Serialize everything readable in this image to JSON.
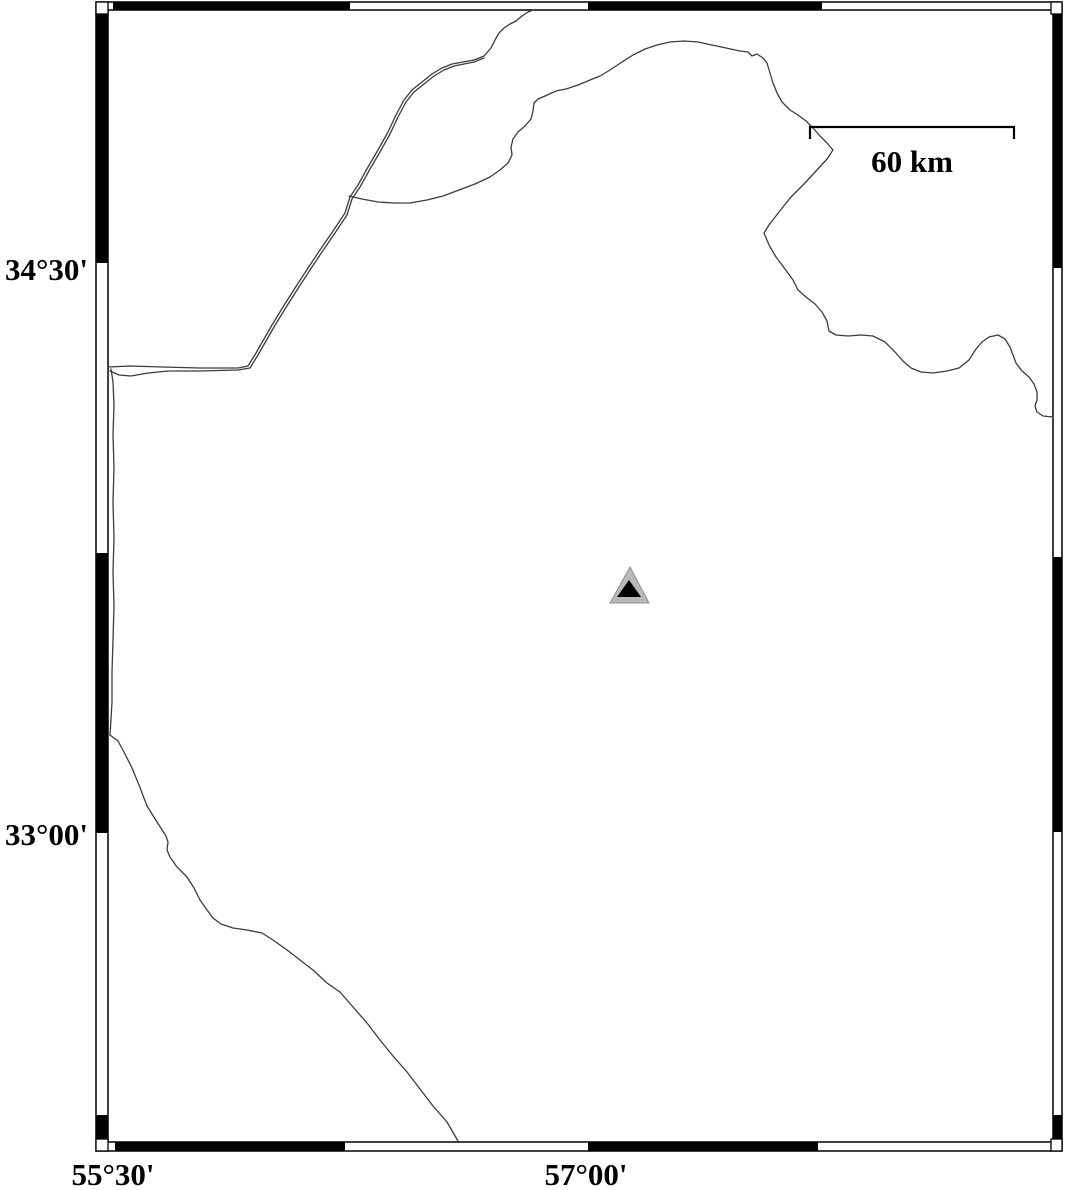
{
  "map": {
    "background": "#ffffff",
    "labels": {
      "lat_top": "34°30'",
      "lat_bottom": "33°00'",
      "lon_left": "55°30'",
      "lon_right": "57°00'"
    },
    "scale_bar": {
      "label": "60 km",
      "x1": 810,
      "x2": 1014,
      "y": 127,
      "tick_drop": 12,
      "stroke": "#000000",
      "stroke_width": 2.2
    },
    "marker": {
      "kind": "station-triangle",
      "outer_fill": "#b9b9b9",
      "outer_stroke": "#8f8f8f",
      "inner_fill": "#000000",
      "outer_points": [
        [
          630,
          567
        ],
        [
          610,
          603
        ],
        [
          649,
          603
        ]
      ],
      "inner_points": [
        [
          629,
          580
        ],
        [
          617,
          597
        ],
        [
          641,
          597
        ]
      ]
    },
    "frame": {
      "band_fill_black": "#000000",
      "band_fill_white": "#ffffff",
      "line_color": "#000000",
      "outer": [
        96,
        2,
        1062,
        1151
      ],
      "inner": [
        108,
        10,
        1053,
        1142
      ],
      "top_black": [
        [
          113,
          350
        ],
        [
          588,
          822
        ]
      ],
      "bottom_black": [
        [
          115,
          345
        ],
        [
          588,
          818
        ]
      ],
      "left_black": [
        [
          10,
          263
        ],
        [
          553,
          833
        ],
        [
          1115,
          1142
        ]
      ],
      "right_black": [
        [
          10,
          268
        ],
        [
          557,
          832
        ],
        [
          1115,
          1142
        ]
      ],
      "corner_squares": [
        [
          96,
          2,
          12,
          12
        ],
        [
          1051,
          2,
          11,
          12
        ],
        [
          96,
          1139,
          12,
          12
        ],
        [
          1051,
          1139,
          11,
          12
        ]
      ]
    },
    "lines": {
      "color": "#3c3c3c",
      "width": 1.3,
      "paths": [
        {
          "name": "border-line-main",
          "points": [
            [
              108,
              367
            ],
            [
              130,
              366
            ],
            [
              162,
              367
            ],
            [
              200,
              368
            ],
            [
              238,
              368
            ],
            [
              248,
              366
            ],
            [
              256,
              353
            ],
            [
              264,
              339
            ],
            [
              272,
              325
            ],
            [
              283,
              307
            ],
            [
              295,
              288
            ],
            [
              308,
              268
            ],
            [
              320,
              250
            ],
            [
              333,
              231
            ],
            [
              345,
              213
            ],
            [
              350,
              197
            ],
            [
              358,
              185
            ],
            [
              368,
              167
            ],
            [
              378,
              150
            ],
            [
              388,
              132
            ],
            [
              396,
              115
            ],
            [
              404,
              100
            ],
            [
              412,
              90
            ],
            [
              422,
              82
            ],
            [
              432,
              74
            ],
            [
              442,
              68
            ],
            [
              452,
              64
            ],
            [
              463,
              62
            ],
            [
              474,
              60
            ],
            [
              484,
              56
            ],
            [
              491,
              48
            ],
            [
              495,
              40
            ],
            [
              499,
              33
            ],
            [
              504,
              28
            ],
            [
              510,
              24
            ],
            [
              516,
              21
            ],
            [
              522,
              16
            ],
            [
              528,
              12
            ],
            [
              533,
              10
            ]
          ]
        },
        {
          "name": "border-line-second-strand",
          "points": [
            [
              110,
              371
            ],
            [
              119,
              375
            ],
            [
              131,
              376
            ],
            [
              148,
              373
            ],
            [
              168,
              371
            ],
            [
              200,
              371
            ],
            [
              238,
              370
            ],
            [
              250,
              368
            ],
            [
              258,
              355
            ],
            [
              266,
              341
            ],
            [
              274,
              327
            ],
            [
              285,
              309
            ],
            [
              297,
              290
            ],
            [
              310,
              270
            ],
            [
              322,
              252
            ],
            [
              335,
              233
            ],
            [
              347,
              215
            ],
            [
              352,
              199
            ],
            [
              360,
              187
            ],
            [
              370,
              169
            ],
            [
              380,
              152
            ],
            [
              390,
              134
            ],
            [
              398,
              117
            ],
            [
              406,
              102
            ],
            [
              414,
              92
            ],
            [
              424,
              84
            ],
            [
              434,
              76
            ],
            [
              444,
              70
            ],
            [
              454,
              66
            ],
            [
              464,
              64
            ],
            [
              474,
              62
            ],
            [
              484,
              58
            ]
          ]
        },
        {
          "name": "coastline-north",
          "points": [
            [
              349,
              196
            ],
            [
              362,
              199
            ],
            [
              378,
              202
            ],
            [
              394,
              203
            ],
            [
              410,
              203
            ],
            [
              427,
              200
            ],
            [
              443,
              196
            ],
            [
              459,
              190
            ],
            [
              475,
              184
            ],
            [
              490,
              177
            ],
            [
              500,
              170
            ],
            [
              508,
              163
            ],
            [
              512,
              155
            ],
            [
              511,
              147
            ],
            [
              513,
              139
            ],
            [
              518,
              132
            ],
            [
              525,
              126
            ],
            [
              531,
              119
            ],
            [
              533,
              111
            ],
            [
              534,
              103
            ],
            [
              538,
              99
            ],
            [
              545,
              96
            ],
            [
              556,
              91
            ],
            [
              566,
              89
            ],
            [
              578,
              85
            ],
            [
              590,
              80
            ],
            [
              600,
              76
            ],
            [
              610,
              70
            ],
            [
              622,
              62
            ],
            [
              633,
              55
            ],
            [
              645,
              49
            ],
            [
              657,
              45
            ],
            [
              670,
              42
            ],
            [
              684,
              41
            ],
            [
              698,
              42
            ],
            [
              712,
              45
            ],
            [
              726,
              48
            ],
            [
              740,
              51
            ],
            [
              748,
              52
            ],
            [
              752,
              56
            ],
            [
              757,
              54
            ],
            [
              763,
              58
            ],
            [
              767,
              63
            ],
            [
              770,
              73
            ],
            [
              773,
              83
            ],
            [
              777,
              93
            ],
            [
              782,
              102
            ],
            [
              790,
              110
            ],
            [
              798,
              115
            ],
            [
              806,
              121
            ],
            [
              813,
              128
            ],
            [
              820,
              136
            ],
            [
              827,
              143
            ],
            [
              833,
              150
            ],
            [
              827,
              159
            ],
            [
              816,
              171
            ],
            [
              804,
              184
            ],
            [
              791,
              197
            ],
            [
              779,
              212
            ],
            [
              769,
              225
            ],
            [
              764,
              233
            ],
            [
              769,
              245
            ],
            [
              776,
              257
            ],
            [
              785,
              269
            ],
            [
              793,
              280
            ],
            [
              798,
              290
            ],
            [
              806,
              297
            ],
            [
              815,
              304
            ],
            [
              822,
              312
            ],
            [
              827,
              321
            ],
            [
              829,
              331
            ],
            [
              836,
              335
            ],
            [
              848,
              336
            ],
            [
              861,
              335
            ],
            [
              873,
              336
            ],
            [
              885,
              342
            ],
            [
              895,
              352
            ],
            [
              903,
              361
            ],
            [
              911,
              368
            ],
            [
              921,
              372
            ],
            [
              933,
              373
            ],
            [
              947,
              371
            ],
            [
              959,
              368
            ],
            [
              969,
              360
            ],
            [
              976,
              349
            ],
            [
              982,
              342
            ],
            [
              989,
              337
            ],
            [
              998,
              335
            ],
            [
              1005,
              339
            ],
            [
              1010,
              347
            ],
            [
              1013,
              355
            ],
            [
              1016,
              363
            ],
            [
              1022,
              371
            ],
            [
              1029,
              377
            ],
            [
              1034,
              384
            ],
            [
              1037,
              392
            ],
            [
              1037,
              400
            ],
            [
              1035,
              406
            ],
            [
              1037,
              412
            ],
            [
              1043,
              416
            ],
            [
              1053,
              417
            ]
          ]
        },
        {
          "name": "border-line-west-edge",
          "points": [
            [
              111,
              369
            ],
            [
              113,
              382
            ],
            [
              114,
              405
            ],
            [
              113,
              435
            ],
            [
              114,
              468
            ],
            [
              113,
              502
            ],
            [
              114,
              538
            ],
            [
              113,
              572
            ],
            [
              114,
              606
            ],
            [
              113,
              640
            ],
            [
              112,
              672
            ],
            [
              112,
              702
            ],
            [
              110,
              735
            ]
          ]
        },
        {
          "name": "coastline-southwest",
          "points": [
            [
              110,
              735
            ],
            [
              118,
              741
            ],
            [
              124,
              752
            ],
            [
              132,
              768
            ],
            [
              139,
              785
            ],
            [
              147,
              806
            ],
            [
              157,
              822
            ],
            [
              166,
              836
            ],
            [
              168,
              842
            ],
            [
              167,
              850
            ],
            [
              170,
              857
            ],
            [
              177,
              867
            ],
            [
              187,
              877
            ],
            [
              194,
              888
            ],
            [
              200,
              900
            ],
            [
              207,
              910
            ],
            [
              213,
              918
            ],
            [
              221,
              924
            ],
            [
              233,
              928
            ],
            [
              247,
              930
            ],
            [
              262,
              933
            ],
            [
              273,
              940
            ],
            [
              287,
              950
            ],
            [
              300,
              960
            ],
            [
              313,
              970
            ],
            [
              327,
              983
            ],
            [
              340,
              992
            ],
            [
              353,
              1007
            ],
            [
              367,
              1023
            ],
            [
              380,
              1040
            ],
            [
              393,
              1056
            ],
            [
              407,
              1072
            ],
            [
              420,
              1089
            ],
            [
              433,
              1106
            ],
            [
              447,
              1122
            ],
            [
              458,
              1141
            ]
          ]
        }
      ]
    }
  }
}
